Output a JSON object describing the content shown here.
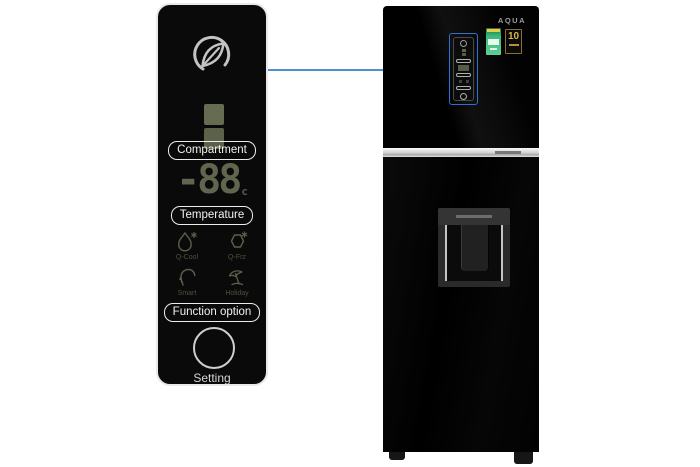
{
  "detail_panel": {
    "logo_icon": "eco-leaf-icon",
    "compartment_label": "Compartment",
    "display": {
      "value": "-88",
      "unit": "c"
    },
    "temperature_label": "Temperature",
    "modes": [
      {
        "label": "Q-Cool",
        "icon": "droplet-snowflake-icon"
      },
      {
        "label": "Q-Frz",
        "icon": "hexagon-snowflake-icon"
      },
      {
        "label": "Smart",
        "icon": "head-profile-icon"
      },
      {
        "label": "Holiday",
        "icon": "umbrella-icon"
      }
    ],
    "function_label": "Function option",
    "setting_label": "Setting"
  },
  "fridge": {
    "brand": "AQUA",
    "warranty_badge_text": "10",
    "badges": [
      "energy-rating-label",
      "10-year-warranty-badge"
    ]
  },
  "colors": {
    "connector_blue": "#4f8fd0",
    "highlight_blue": "#2f6fd6",
    "display_olive": "#60654e",
    "warranty_gold": "#d9b64a",
    "energy_green": "#3cb878"
  }
}
